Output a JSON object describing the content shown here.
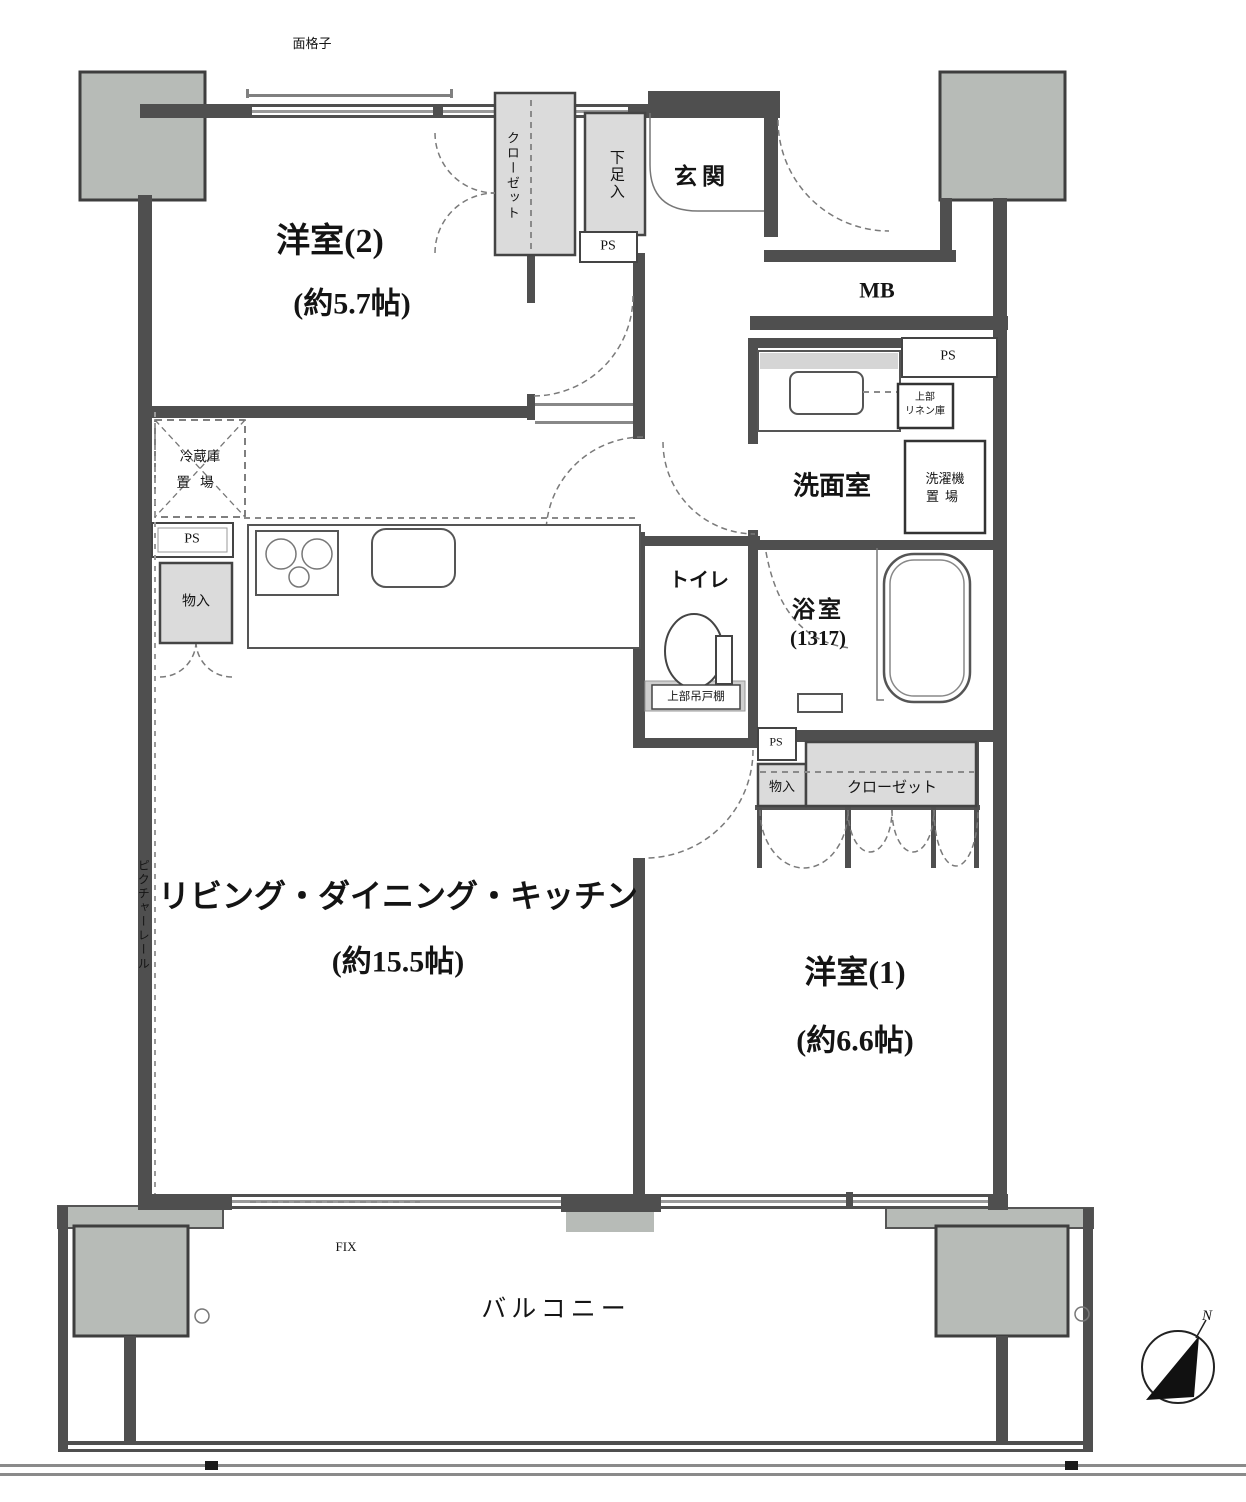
{
  "plan": {
    "rooms": {
      "western2": {
        "name": "洋室(2)",
        "size": "(約5.7帖)"
      },
      "ldk": {
        "name": "リビング・ダイニング・キッチン",
        "size": "(約15.5帖)"
      },
      "western1": {
        "name": "洋室(1)",
        "size": "(約6.6帖)"
      },
      "entrance": {
        "name": "玄関"
      },
      "washroom": {
        "name": "洗面室"
      },
      "bathroom": {
        "name": "浴室",
        "size": "(1317)"
      },
      "toilet": {
        "name": "トイレ"
      },
      "balcony": {
        "name": "バルコニー"
      }
    },
    "storage": {
      "closet_top": "クローゼット",
      "closet_right": "クローゼット",
      "shoe_box": "下足入",
      "storage_left": "物入",
      "storage_right": "物入",
      "linen_line1": "上部",
      "linen_line2": "リネン庫",
      "laundry_line1": "洗濯機",
      "laundry_line2": "置場",
      "fridge_line1": "冷蔵庫",
      "fridge_line2": "置場",
      "toilet_shelf": "上部吊戸棚"
    },
    "service": {
      "mb": "MB",
      "ps_entrance": "PS",
      "ps_right": "PS",
      "ps_kitchen": "PS",
      "ps_middle": "PS"
    },
    "annotations": {
      "lattice": "面格子",
      "picture_rail": "ピクチャーレール",
      "fix_window": "FIX",
      "north": "N"
    },
    "colors": {
      "wall": "#4f4f4f",
      "pillar": "#b7bbb7",
      "storage_fill": "#dbdbdb",
      "line": "#777777",
      "background": "#ffffff"
    }
  }
}
